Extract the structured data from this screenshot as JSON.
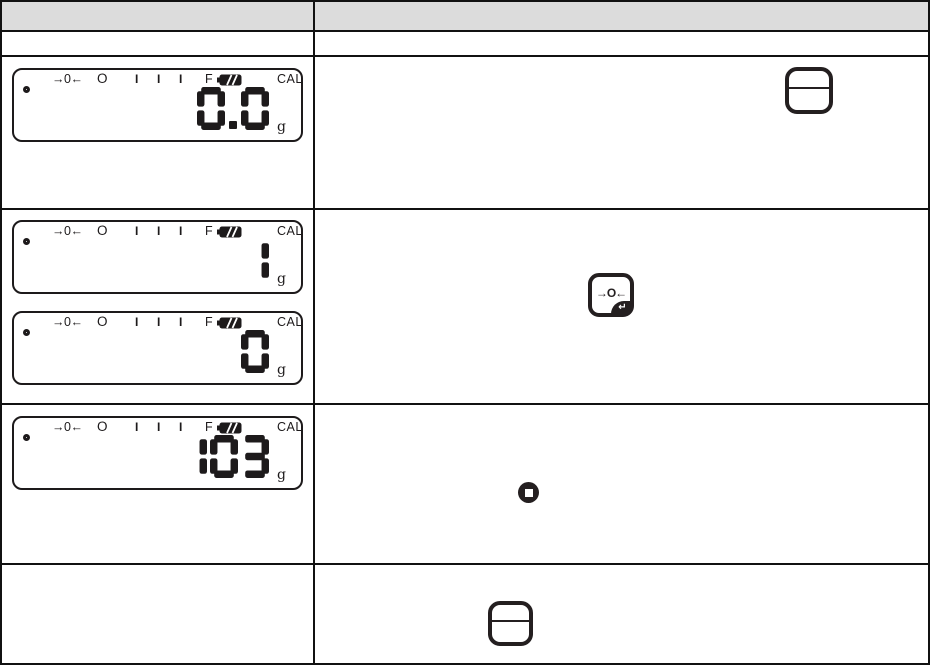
{
  "document": {
    "type": "scale-operation-instruction-table",
    "header": {
      "left_label": "",
      "right_label": ""
    }
  },
  "lcd_common": {
    "zero_indicator": "→0←",
    "o_indicator": "O",
    "range_bars": [
      "I",
      "I",
      "I"
    ],
    "f_indicator": "F",
    "battery_icon": "battery-full-icon",
    "cal_indicator": "CAL",
    "unit": "g"
  },
  "displays": {
    "p1": "0.0",
    "p2": "1",
    "p3": "0",
    "p4": "103"
  },
  "keys": {
    "onoff_key": "on-off-key",
    "zero_label": "→O←",
    "enter_symbol": "↵",
    "stop_symbol": "stop-print-symbol"
  },
  "colors": {
    "header_bg": "#dcdcdc",
    "ink": "#1d1a1b",
    "border": "#111111"
  }
}
